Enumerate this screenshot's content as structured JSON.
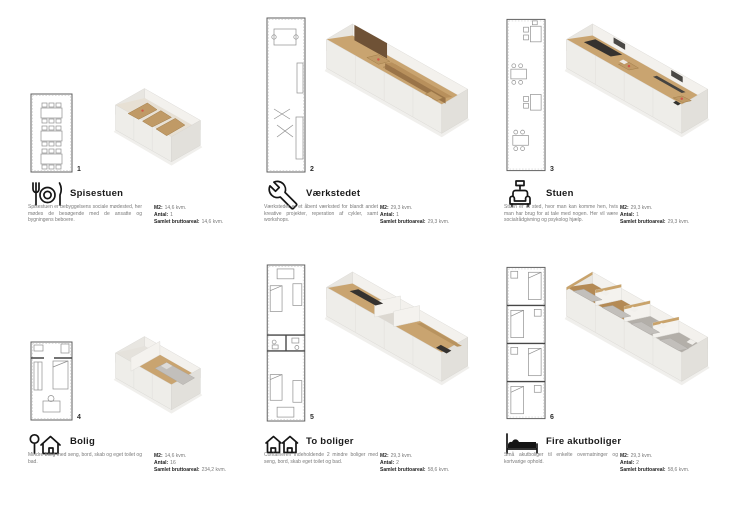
{
  "labels": {
    "m2": "M2:",
    "antal": "Antal:",
    "areal": "Samlet bruttoareal:"
  },
  "sections": [
    {
      "number": "1",
      "title": "Spisestuen",
      "icon": "dining-icon",
      "description": "Spisestuen er bebyggelsens sociale mødested, her mødes de besøgende med de ansatte og bygningens beboere.",
      "m2": "14,6 kvm.",
      "antal": "1",
      "areal": "14,6 kvm."
    },
    {
      "number": "2",
      "title": "Værkstedet",
      "icon": "wrench-icon",
      "description": "Værkstedet er et åbent værksted for blandt andet kreative projekter, reperation af cykler, samt workshops.",
      "m2": "29,3 kvm.",
      "antal": "1",
      "areal": "29,3 kvm."
    },
    {
      "number": "3",
      "title": "Stuen",
      "icon": "sofa-icon",
      "description": "Stuen er et sted, hvor man kan komme hen, hvis man har brug for at tale med nogen. Her vil være socialrådgivning og psykolog hjælp.",
      "m2": "29,3 kvm.",
      "antal": "1",
      "areal": "29,3 kvm."
    },
    {
      "number": "4",
      "title": "Bolig",
      "icon": "house-icon",
      "description": "Mindre bolig med seng, bord, skab og eget toilet og bad.",
      "m2": "14,6 kvm.",
      "antal": "16",
      "areal": "234,2 kvm."
    },
    {
      "number": "5",
      "title": "To boliger",
      "icon": "two-houses-icon",
      "description": "Containeren indeholdende 2 mindre boliger med seng, bord, skab eget toilet og bad.",
      "m2": "29,3 kvm.",
      "antal": "2",
      "areal": "58,6 kvm."
    },
    {
      "number": "6",
      "title": "Fire akutboliger",
      "icon": "bed-icon",
      "description": "Små akutboliger til enkelte overnatninger og kortvarige ophold.",
      "m2": "29,3 kvm.",
      "antal": "2",
      "areal": "58,6 kvm."
    }
  ],
  "colors": {
    "wood": "#c9a470",
    "container": "#eeede9",
    "accent_red": "#d25549",
    "dark_furniture": "#35322f",
    "title_text": "#1a1a1a",
    "body_text": "#7a7a7a"
  }
}
